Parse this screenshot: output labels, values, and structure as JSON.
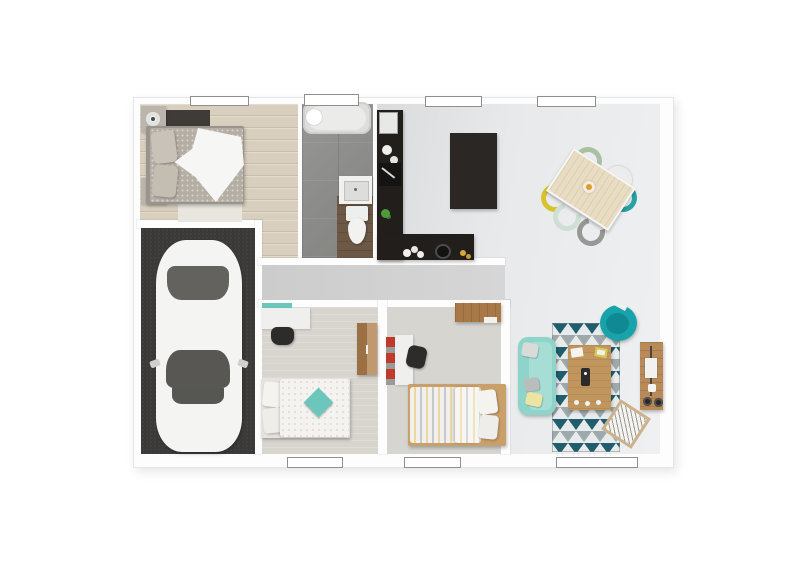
{
  "scene": {
    "type": "3d-rendered-floor-plan-top-view",
    "description": "Single-storey house plan: master bedroom, bathroom, open kitchen/dining/living space, garage with car, hallway, two small bedrooms",
    "window_count": 7,
    "rooms": [
      {
        "name": "master-bedroom",
        "floor": "light wood planks",
        "furniture": [
          "double-bed with gray patterned duvet and white throw",
          "two nightstands with lamps",
          "dark bench-runner",
          "white bedside rug"
        ]
      },
      {
        "name": "bathroom",
        "floor": "gray tiles with wood strip",
        "furniture": [
          "bathtub",
          "washbasin",
          "toilet"
        ]
      },
      {
        "name": "kitchen",
        "floor": "light gray",
        "furniture": [
          "L-shaped dark counter",
          "dark island",
          "oven",
          "kettle",
          "cutting board",
          "plant",
          "sink",
          "cooktop"
        ]
      },
      {
        "name": "dining-area",
        "floor": "light gray",
        "furniture": [
          "rotated light-wood table",
          "fruit bowl",
          "6 chairs: sage, white, teal, yellow, mint, gray"
        ]
      },
      {
        "name": "living-room",
        "floor": "light gray",
        "furniture": [
          "teal sofa with pillows",
          "geometric triangle rug",
          "wood coffee table",
          "teal round armchair",
          "wood tv-sideboard with tv and speakers",
          "magazine basket"
        ]
      },
      {
        "name": "garage",
        "floor": "dark concrete",
        "furniture": [
          "white car seen from above"
        ]
      },
      {
        "name": "hallway",
        "floor": "gray",
        "furniture": []
      },
      {
        "name": "bedroom-2",
        "floor": "light carpet",
        "furniture": [
          "white desk with teal shelf",
          "dark desk chair",
          "wood wardrobe",
          "single bed with white duvet and teal cushion"
        ]
      },
      {
        "name": "bedroom-3",
        "floor": "light carpet",
        "furniture": [
          "wood wall shelf",
          "white desk with red storage unit",
          "dark desk chair",
          "single bed with striped duvet and wood frame"
        ]
      }
    ]
  },
  "colors": {
    "wall": "#fdfdfd",
    "floor-wood": "#d8cfbe",
    "floor-tile": "#8f8f8d",
    "floor-garage": "#3c3a38",
    "floor-carpet": "#d8d5ce",
    "brown-mat": "#6d5846",
    "counter-dark": "#211e1c",
    "island-dark": "#2b2725",
    "teal-sofa": "#8fd4cb",
    "teal-armchair": "#18a3ab",
    "teal-accent": "#6cc6bc",
    "rug-dark": "#205e6e",
    "rug-gray": "#9fa9ab",
    "rug-light": "#e8ebeb",
    "wood-mid": "#c1955e",
    "wood-tv": "#b78a58",
    "wood-shelf": "#a87947",
    "wood-wardrobe": "#b0804e",
    "table-wood": "#e8dcc3",
    "chair-sage": "#a9c0a2",
    "chair-white": "#ececea",
    "chair-teal": "#29a2a6",
    "chair-yellow": "#d8c32f",
    "chair-mint": "#cfdfd3",
    "chair-gray": "#969896",
    "fruit-orange": "#e09b2d",
    "red-unit": "#c0392b",
    "dark-furniture": "#2e2c2a",
    "car-body": "#f4f4f2",
    "car-glass": "#63625f",
    "duvet-gray": "#b5aea4",
    "white-linen": "#f4f3f0",
    "green-plant": "#4e9b3a"
  }
}
